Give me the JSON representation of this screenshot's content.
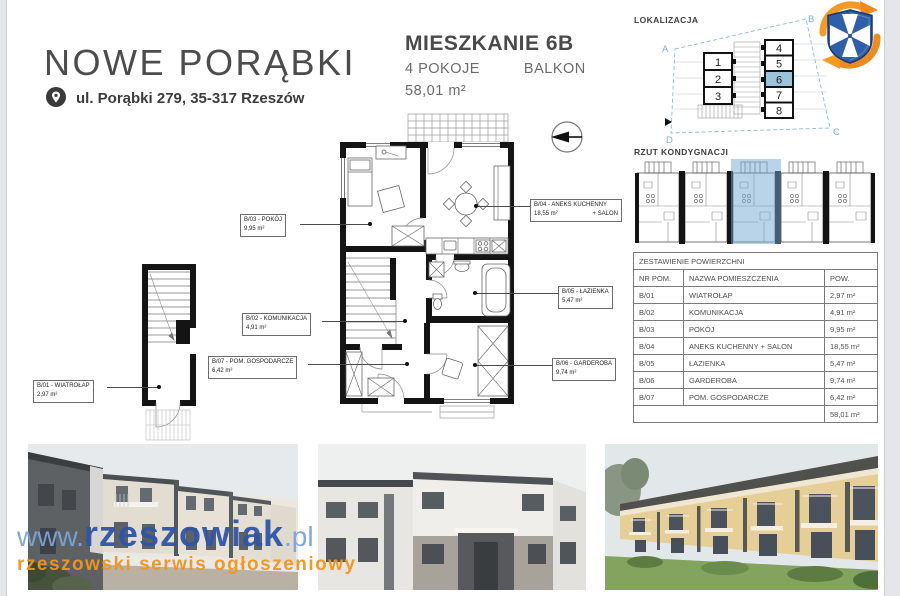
{
  "header": {
    "title": "NOWE PORĄBKI",
    "address": "ul. Porąbki 279, 35-317 Rzeszów"
  },
  "apartment": {
    "name": "MIESZKANIE 6B",
    "rooms": "4 POKOJE",
    "feature": "BALKON",
    "area": "58,01 m²"
  },
  "lokalizacja": {
    "label": "LOKALIZACJA",
    "corners": [
      "A",
      "B",
      "C",
      "D"
    ],
    "left_units": [
      "1",
      "2",
      "3"
    ],
    "right_units": [
      "4",
      "5",
      "6",
      "7",
      "8"
    ],
    "highlighted_unit": "6"
  },
  "rzut": {
    "label": "RZUT KONDYGNACJI"
  },
  "area_table": {
    "title": "ZESTAWIENIE POWIERZCHNI",
    "headers": [
      "NR POM.",
      "NAZWA POMIESZCZENIA",
      "POW."
    ],
    "rows": [
      [
        "B/01",
        "WIATROŁAP",
        "2,97 m²"
      ],
      [
        "B/02",
        "KOMUNIKACJA",
        "4,91 m²"
      ],
      [
        "B/03",
        "POKÓJ",
        "9,95 m²"
      ],
      [
        "B/04",
        "ANEKS KUCHENNY + SALON",
        "18,55 m²"
      ],
      [
        "B/05",
        "ŁAZIENKA",
        "5,47 m²"
      ],
      [
        "B/06",
        "GARDEROBA",
        "9,74 m²"
      ],
      [
        "B/07",
        "POM. GOSPODARCZE",
        "6,42 m²"
      ]
    ],
    "total": "58,01 m²"
  },
  "plan_labels": {
    "b03": {
      "name": "B/03 - POKÓJ",
      "area": "9,95 m²"
    },
    "b04": {
      "name": "B/04 - ANEKS KUCHENNY",
      "area": "18,55 m²",
      "suffix": "+ SALON"
    },
    "b02": {
      "name": "B/02 - KOMUNIKACJA",
      "area": "4,91 m²"
    },
    "b05": {
      "name": "B/05 - ŁAZIENKA",
      "area": "5,47 m²"
    },
    "b07": {
      "name": "B/07 - POM. GOSPODARCZE",
      "area": "6,42 m²"
    },
    "b06": {
      "name": "B/06 - GARDEROBA",
      "area": "9,74 m²"
    },
    "b01": {
      "name": "B/01 - WIATROŁAP",
      "area": "2,97 m²"
    }
  },
  "watermark": {
    "www": "www.",
    "brand": "rzeszowiak",
    "tld": ".pl",
    "tagline": "rzeszowski serwis ogłoszeniowy"
  },
  "colors": {
    "accent_blue": "#74b4d6",
    "highlight_fill": "#9cc3de",
    "watermark_blue": "#2d55a8",
    "watermark_light_blue": "#7aa4d6",
    "watermark_orange": "#f2951d",
    "logo_blue": "#2f5fa8",
    "logo_orange": "#ef8a1d"
  }
}
